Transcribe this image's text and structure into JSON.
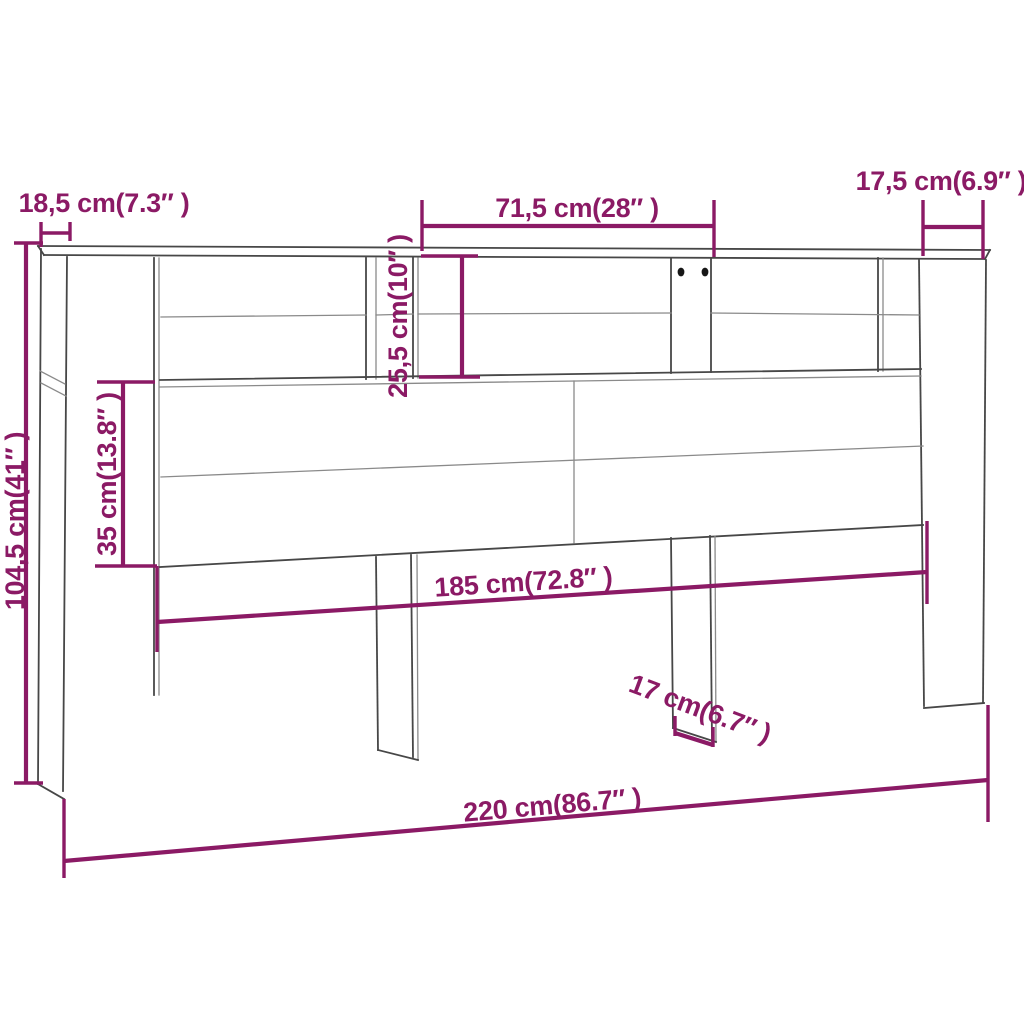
{
  "diagram": {
    "kind": "furniture-dimension-diagram",
    "colors": {
      "dimension_accent": "#8b1a65",
      "outline": "#474747",
      "outline_light": "#8a8a8a",
      "background": "#ffffff",
      "screw_hole": "#161616"
    },
    "dimensions": {
      "top_left_width": {
        "label": "18,5 cm(7.3″ )"
      },
      "overall_height": {
        "label": "104,5 cm(41″ )"
      },
      "top_center_width": {
        "label": "71,5 cm(28″ )"
      },
      "top_right_depth": {
        "label": "17,5 cm(6.9″ )"
      },
      "shelf_height": {
        "label": "25,5 cm(10″ )"
      },
      "panel_height": {
        "label": "35 cm(13.8″ )"
      },
      "inner_width": {
        "label": "185 cm(72.8″ )"
      },
      "leg_depth": {
        "label": "17 cm(6.7″ )"
      },
      "overall_width": {
        "label": "220 cm(86.7″ )"
      }
    }
  }
}
